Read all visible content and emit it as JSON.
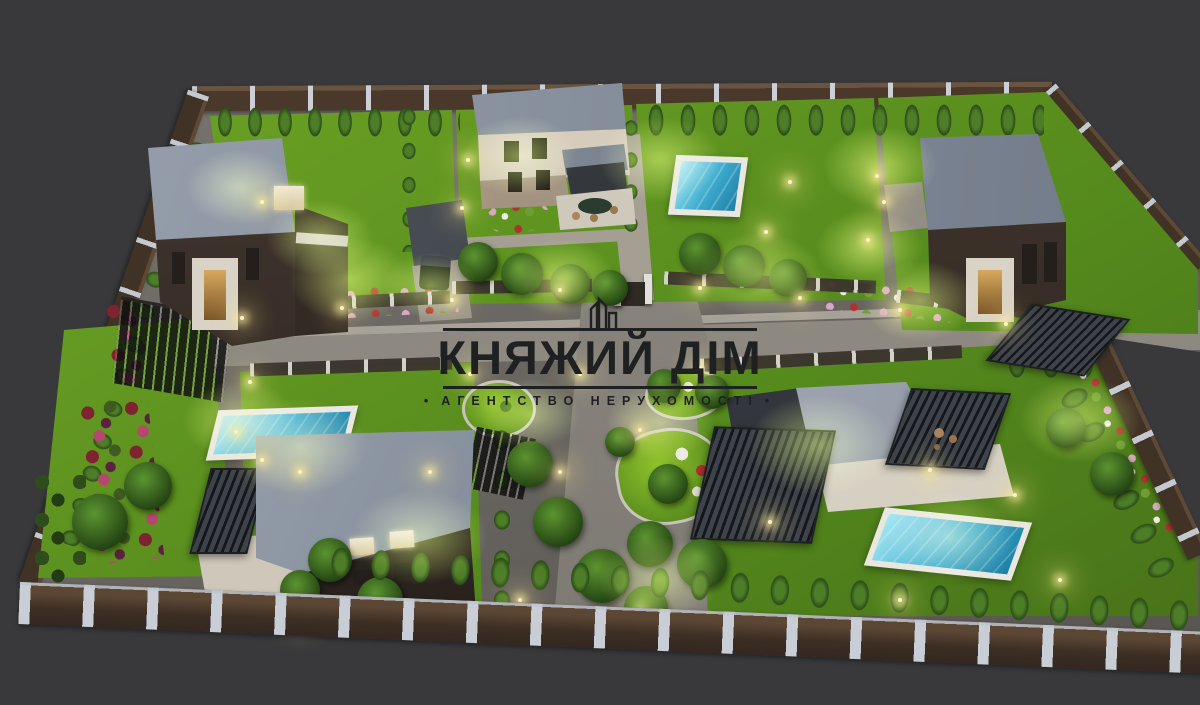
{
  "meta": {
    "type": "3d-architectural-render",
    "subject": "Aerial dusk view of a gated cottage estate: five modern flat-roof houses, lit lawns, three swimming pools, private road, perimeter fence"
  },
  "watermark": {
    "icon": "buildings-logo-icon",
    "title": "КНЯЖИЙ ДІМ",
    "subtitle": "АГЕНТСТВО НЕРУХОМОСТІ",
    "subtitle_prefix_bullet": "•",
    "subtitle_suffix_bullet": "•"
  },
  "palette": {
    "background": "#39393b",
    "road": "#8d8981",
    "lawn": "#5e9120",
    "lawn_lit": "#a8d437",
    "tree_dark": "#2b4c1a",
    "roof_gray": "#99a1ae",
    "wall_cream": "#d9d1c2",
    "wall_dark": "#3b322b",
    "pool_water": "#41b4d8",
    "pool_deck": "#e9e7e0",
    "fence_panel": "#4a392b",
    "fence_post": "#ccd0d6",
    "watermark_ink": "#1e2022",
    "lamp_glow": "#ffeea0"
  },
  "scene": {
    "houses": [
      {
        "id": "house-top-left",
        "style": "two-story, dark facade, flat gray roof, white entry portal"
      },
      {
        "id": "house-top-center",
        "style": "two-story, cream facade, flat gray roof, carport with car, pergola dining terrace"
      },
      {
        "id": "house-top-right",
        "style": "two-story, dark facade, flat gray roof, white entry portal, carport"
      },
      {
        "id": "house-bottom-left",
        "style": "large flat gray roof, dark walls with lit windows, pergola and wood deck"
      },
      {
        "id": "house-bottom-right",
        "style": "single-story, flat roof, two slatted pergolas, terrace"
      }
    ],
    "pools": 3,
    "lighting": "garden lamps lit, dusk"
  }
}
